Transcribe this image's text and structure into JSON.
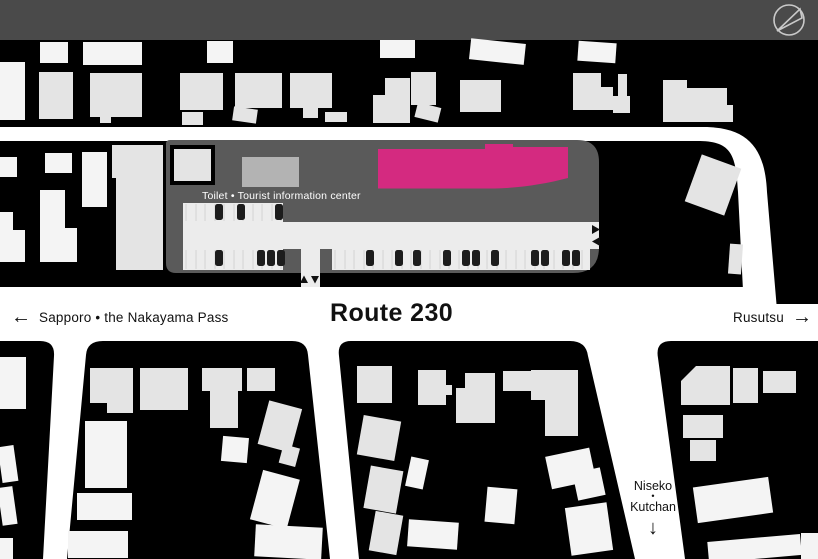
{
  "header": {
    "compass_icon": "compass-north-mark"
  },
  "map": {
    "site": {
      "label": "Toilet • Tourist information center"
    },
    "roads": {
      "route_label": "Route 230",
      "west_label": "Sapporo • the Nakayama Pass",
      "west_arrow": "←",
      "east_label": "Rusutsu",
      "east_arrow": "→",
      "south_label_line1": "Niseko",
      "south_label_dot": "•",
      "south_label_line2": "Kutchan",
      "south_arrow": "↓"
    },
    "parking": {
      "driveway_entry_markers": [
        "▲",
        "▼"
      ],
      "side_entry_markers": [
        "▶",
        "◀"
      ]
    },
    "colors": {
      "background": "#000000",
      "top_bar": "#4a4a4a",
      "site": "#5a5a5a",
      "highlight_building": "#d42a80",
      "building_gray": "#b3b3b3",
      "building_light": "#e4e4e4",
      "building_white": "#f4f4f4",
      "parking_surface": "#ececec",
      "stall_line": "#d7d7d7",
      "road": "#ffffff",
      "car": "#1c1c1c",
      "text_dark": "#111111",
      "text_light": "#ffffff",
      "compass": "#c9c9c9"
    }
  }
}
